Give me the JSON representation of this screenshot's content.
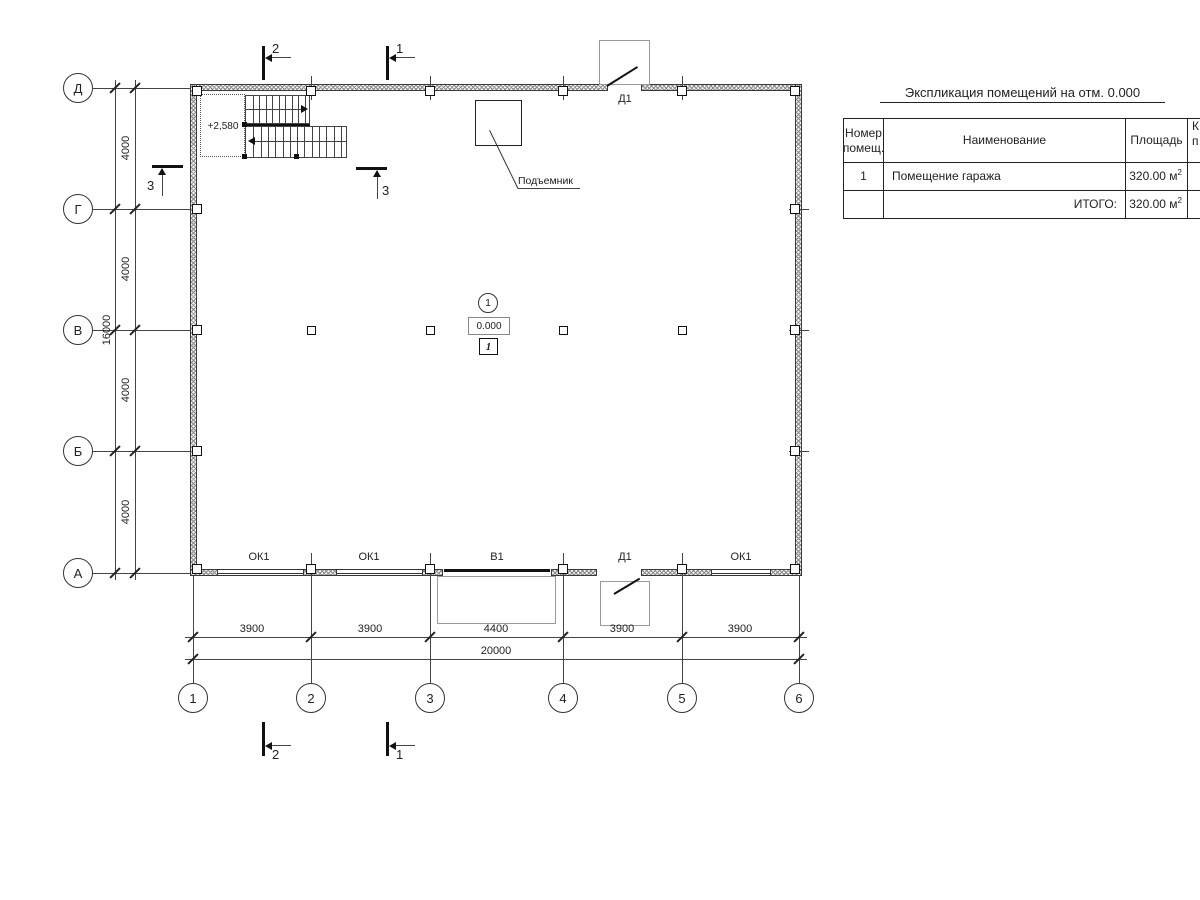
{
  "drawing": {
    "axes_rows": [
      "Д",
      "Г",
      "В",
      "Б",
      "А"
    ],
    "axes_cols": [
      "1",
      "2",
      "3",
      "4",
      "5",
      "6"
    ],
    "dim_rows": [
      "4000",
      "4000",
      "4000",
      "4000"
    ],
    "dim_rows_total": "16000",
    "dim_cols": [
      "3900",
      "3900",
      "4400",
      "3900",
      "3900"
    ],
    "dim_cols_total": "20000",
    "sections": {
      "s1": "1",
      "s2": "2",
      "s3": "3"
    },
    "labels": {
      "door": "Д1",
      "gate": "В1",
      "window": "ОК1",
      "lift": "Подъемник",
      "stair_elevation": "+2,580",
      "room_number": "1",
      "level": "0.000",
      "room_tag": "1"
    }
  },
  "table": {
    "title": "Экспликация помещений на отм. 0.000",
    "headers": {
      "num": [
        "Номер",
        "помещ."
      ],
      "name": "Наименование",
      "area": "Площадь",
      "cut": [
        "К",
        "п"
      ]
    },
    "rows": [
      {
        "num": "1",
        "name": "Помещение гаража",
        "area": "320.00 м",
        "area_sup": "2"
      }
    ],
    "total": {
      "label": "ИТОГО:",
      "area": "320.00 м",
      "area_sup": "2"
    }
  }
}
